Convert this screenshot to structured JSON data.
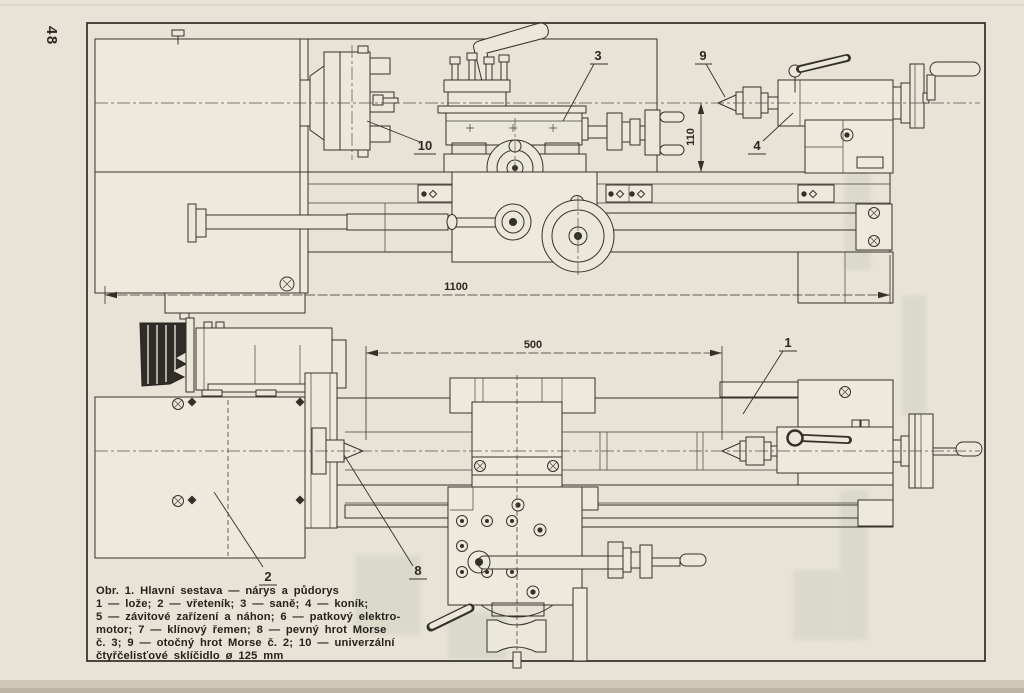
{
  "page": {
    "number": "48"
  },
  "figure": {
    "callouts": {
      "c1": "1",
      "c2": "2",
      "c3": "3",
      "c4": "4",
      "c8": "8",
      "c9": "9",
      "c10": "10"
    },
    "dimensions": {
      "overall_length": "1100",
      "between_centers": "500",
      "center_height": "110"
    }
  },
  "caption": {
    "lines": [
      "Obr. 1. Hlavní sestava — nárys a půdorys",
      "1 — lože; 2 — vřeteník; 3 — saně; 4 — koník;",
      "5 — závitové zařízení a náhon; 6 — patkový elektro-",
      "motor; 7 — klínový řemen; 8 — pevný hrot Morse",
      "č. 3; 9 — otočný hrot Morse č. 2; 10 — univerzální",
      "čtyřčelisťové sklíčidlo ø 125 mm"
    ]
  },
  "colors": {
    "paper": "#e8e3d6",
    "ink": "#35322b"
  }
}
